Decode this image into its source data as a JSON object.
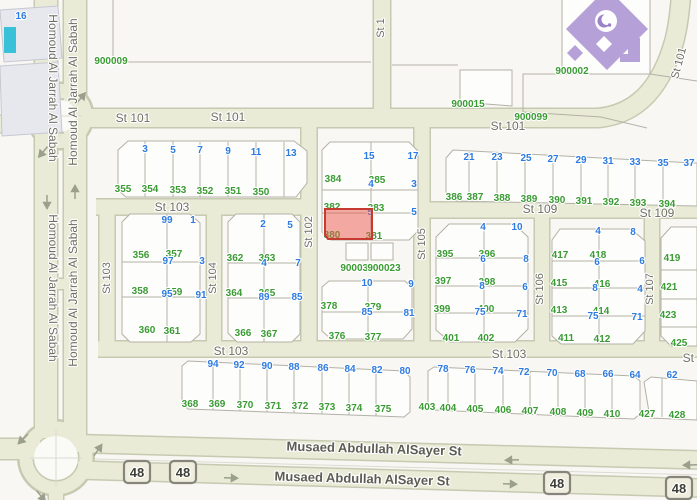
{
  "map": {
    "highlighted_parcel": {
      "number": "380",
      "status": "selected"
    },
    "poi": {
      "type": "mosque",
      "icon": "crescent-and-star"
    },
    "colors": {
      "bg": "#f8f7f4",
      "block_fill": "#fdfdfb",
      "road_fill": "#e9ebd6",
      "road_casing": "#c6cab0",
      "parcel_line": "#b3b1a6",
      "parcel_green": "#3a9b33",
      "address_blue": "#2d7be0",
      "street_text": "#6e6e64",
      "major_street_text": "#5c5c54",
      "highlight_fill": "#ea5548",
      "highlight_stroke": "#c63b30",
      "mosque": "#b6a0d8",
      "building": "#e7e7ee",
      "teal": "#38c1d8",
      "shield_fill": "#efeede",
      "shield_border": "#85857a",
      "arrow": "#9aa08c",
      "inner_circle": "#fafaf7"
    },
    "route_shields": [
      {
        "label": "48",
        "x": 137,
        "y": 472
      },
      {
        "label": "48",
        "x": 183,
        "y": 472
      },
      {
        "label": "48",
        "x": 557,
        "y": 483
      },
      {
        "label": "48",
        "x": 679,
        "y": 488
      }
    ],
    "labels": [
      {
        "t": "St 101",
        "x": 133,
        "y": 122,
        "c": "st"
      },
      {
        "t": "St 101",
        "x": 228,
        "y": 121,
        "c": "st"
      },
      {
        "t": "St 101",
        "x": 508,
        "y": 130,
        "c": "st"
      },
      {
        "t": "St 101",
        "x": 682,
        "y": 64,
        "c": "stv",
        "r": -75
      },
      {
        "t": "St 1",
        "x": 384,
        "y": 28,
        "c": "stv",
        "r": -90
      },
      {
        "t": "St 103",
        "x": 172,
        "y": 211,
        "c": "st"
      },
      {
        "t": "St 103",
        "x": 110,
        "y": 278,
        "c": "stv",
        "r": -90
      },
      {
        "t": "St 102",
        "x": 312,
        "y": 232,
        "c": "stv",
        "r": -90
      },
      {
        "t": "St 104",
        "x": 216,
        "y": 278,
        "c": "stv",
        "r": -90
      },
      {
        "t": "St 105",
        "x": 425,
        "y": 244,
        "c": "stv",
        "r": -90
      },
      {
        "t": "St 109",
        "x": 540,
        "y": 213,
        "c": "st"
      },
      {
        "t": "St 109",
        "x": 657,
        "y": 217,
        "c": "st"
      },
      {
        "t": "St 106",
        "x": 543,
        "y": 289,
        "c": "stv",
        "r": -90
      },
      {
        "t": "St 107",
        "x": 653,
        "y": 289,
        "c": "stv",
        "r": -90
      },
      {
        "t": "St 103",
        "x": 231,
        "y": 355,
        "c": "st"
      },
      {
        "t": "St 103",
        "x": 509,
        "y": 358,
        "c": "st"
      },
      {
        "t": "St 103",
        "x": 700,
        "y": 362,
        "c": "st"
      },
      {
        "t": "Musaed Abdullah AlSayer St",
        "x": 374,
        "y": 453,
        "c": "big",
        "r": 1.6
      },
      {
        "t": "Musaed Abdullah AlSayer St",
        "x": 362,
        "y": 483,
        "c": "big",
        "r": 1.6
      },
      {
        "t": "Homoud Al Jarrah Al Sabah",
        "x": 49,
        "y": 88,
        "c": "st",
        "r": 90
      },
      {
        "t": "Homoud Al Jarrah Al Sabah",
        "x": 49,
        "y": 288,
        "c": "st",
        "r": 90
      },
      {
        "t": "Homoud Al Jarrah Al Sabah",
        "x": 77,
        "y": 92,
        "c": "st",
        "r": -90
      },
      {
        "t": "Homoud Al Jarrah Al Sabah",
        "x": 77,
        "y": 293,
        "c": "st",
        "r": -90
      },
      {
        "t": "355",
        "x": 123,
        "y": 192,
        "c": "g"
      },
      {
        "t": "354",
        "x": 150,
        "y": 192,
        "c": "g"
      },
      {
        "t": "353",
        "x": 178,
        "y": 193,
        "c": "g"
      },
      {
        "t": "352",
        "x": 205,
        "y": 194,
        "c": "g"
      },
      {
        "t": "351",
        "x": 233,
        "y": 194,
        "c": "g"
      },
      {
        "t": "350",
        "x": 261,
        "y": 195,
        "c": "g"
      },
      {
        "t": "356",
        "x": 141,
        "y": 258,
        "c": "g"
      },
      {
        "t": "357",
        "x": 174,
        "y": 257,
        "c": "g"
      },
      {
        "t": "358",
        "x": 140,
        "y": 294,
        "c": "g"
      },
      {
        "t": "359",
        "x": 174,
        "y": 295,
        "c": "g"
      },
      {
        "t": "360",
        "x": 147,
        "y": 333,
        "c": "g"
      },
      {
        "t": "361",
        "x": 172,
        "y": 334,
        "c": "g"
      },
      {
        "t": "362",
        "x": 235,
        "y": 261,
        "c": "g"
      },
      {
        "t": "363",
        "x": 267,
        "y": 261,
        "c": "g"
      },
      {
        "t": "364",
        "x": 234,
        "y": 296,
        "c": "g"
      },
      {
        "t": "365",
        "x": 267,
        "y": 296,
        "c": "g"
      },
      {
        "t": "366",
        "x": 243,
        "y": 336,
        "c": "g"
      },
      {
        "t": "367",
        "x": 269,
        "y": 337,
        "c": "g"
      },
      {
        "t": "384",
        "x": 333,
        "y": 182,
        "c": "g"
      },
      {
        "t": "385",
        "x": 377,
        "y": 183,
        "c": "g"
      },
      {
        "t": "382",
        "x": 332,
        "y": 210,
        "c": "g"
      },
      {
        "t": "383",
        "x": 376,
        "y": 211,
        "c": "g"
      },
      {
        "t": "380",
        "x": 332,
        "y": 238,
        "c": "g"
      },
      {
        "t": "381",
        "x": 374,
        "y": 239,
        "c": "g"
      },
      {
        "t": "378",
        "x": 329,
        "y": 309,
        "c": "g"
      },
      {
        "t": "379",
        "x": 373,
        "y": 310,
        "c": "g"
      },
      {
        "t": "376",
        "x": 337,
        "y": 339,
        "c": "g"
      },
      {
        "t": "377",
        "x": 373,
        "y": 340,
        "c": "g"
      },
      {
        "t": "386",
        "x": 454,
        "y": 200,
        "c": "g"
      },
      {
        "t": "387",
        "x": 475,
        "y": 200,
        "c": "g"
      },
      {
        "t": "388",
        "x": 502,
        "y": 201,
        "c": "g"
      },
      {
        "t": "389",
        "x": 529,
        "y": 202,
        "c": "g"
      },
      {
        "t": "390",
        "x": 557,
        "y": 203,
        "c": "g"
      },
      {
        "t": "391",
        "x": 584,
        "y": 204,
        "c": "g"
      },
      {
        "t": "392",
        "x": 611,
        "y": 205,
        "c": "g"
      },
      {
        "t": "393",
        "x": 638,
        "y": 206,
        "c": "g"
      },
      {
        "t": "394",
        "x": 667,
        "y": 207,
        "c": "g"
      },
      {
        "t": "395",
        "x": 445,
        "y": 257,
        "c": "g"
      },
      {
        "t": "396",
        "x": 487,
        "y": 257,
        "c": "g"
      },
      {
        "t": "397",
        "x": 443,
        "y": 284,
        "c": "g"
      },
      {
        "t": "398",
        "x": 487,
        "y": 285,
        "c": "g"
      },
      {
        "t": "399",
        "x": 442,
        "y": 312,
        "c": "g"
      },
      {
        "t": "400",
        "x": 486,
        "y": 312,
        "c": "g"
      },
      {
        "t": "401",
        "x": 451,
        "y": 341,
        "c": "g"
      },
      {
        "t": "402",
        "x": 486,
        "y": 341,
        "c": "g"
      },
      {
        "t": "417",
        "x": 560,
        "y": 258,
        "c": "g"
      },
      {
        "t": "418",
        "x": 598,
        "y": 258,
        "c": "g"
      },
      {
        "t": "415",
        "x": 559,
        "y": 286,
        "c": "g"
      },
      {
        "t": "416",
        "x": 602,
        "y": 287,
        "c": "g"
      },
      {
        "t": "413",
        "x": 559,
        "y": 313,
        "c": "g"
      },
      {
        "t": "414",
        "x": 601,
        "y": 314,
        "c": "g"
      },
      {
        "t": "411",
        "x": 566,
        "y": 341,
        "c": "g"
      },
      {
        "t": "412",
        "x": 602,
        "y": 342,
        "c": "g"
      },
      {
        "t": "419",
        "x": 672,
        "y": 261,
        "c": "g"
      },
      {
        "t": "421",
        "x": 669,
        "y": 290,
        "c": "g"
      },
      {
        "t": "423",
        "x": 668,
        "y": 318,
        "c": "g"
      },
      {
        "t": "425",
        "x": 679,
        "y": 346,
        "c": "g"
      },
      {
        "t": "368",
        "x": 190,
        "y": 407,
        "c": "g"
      },
      {
        "t": "369",
        "x": 217,
        "y": 407,
        "c": "g"
      },
      {
        "t": "370",
        "x": 245,
        "y": 408,
        "c": "g"
      },
      {
        "t": "371",
        "x": 273,
        "y": 409,
        "c": "g"
      },
      {
        "t": "372",
        "x": 300,
        "y": 409,
        "c": "g"
      },
      {
        "t": "373",
        "x": 327,
        "y": 410,
        "c": "g"
      },
      {
        "t": "374",
        "x": 354,
        "y": 411,
        "c": "g"
      },
      {
        "t": "375",
        "x": 383,
        "y": 412,
        "c": "g"
      },
      {
        "t": "403",
        "x": 427,
        "y": 410,
        "c": "g"
      },
      {
        "t": "404",
        "x": 448,
        "y": 411,
        "c": "g"
      },
      {
        "t": "405",
        "x": 475,
        "y": 412,
        "c": "g"
      },
      {
        "t": "406",
        "x": 503,
        "y": 413,
        "c": "g"
      },
      {
        "t": "407",
        "x": 530,
        "y": 414,
        "c": "g"
      },
      {
        "t": "408",
        "x": 558,
        "y": 415,
        "c": "g"
      },
      {
        "t": "409",
        "x": 585,
        "y": 416,
        "c": "g"
      },
      {
        "t": "410",
        "x": 612,
        "y": 417,
        "c": "g"
      },
      {
        "t": "427",
        "x": 647,
        "y": 417,
        "c": "g"
      },
      {
        "t": "428",
        "x": 677,
        "y": 418,
        "c": "g"
      },
      {
        "t": "900009",
        "x": 111,
        "y": 64,
        "c": "g"
      },
      {
        "t": "900015",
        "x": 468,
        "y": 107,
        "c": "g"
      },
      {
        "t": "900099",
        "x": 531,
        "y": 120,
        "c": "g"
      },
      {
        "t": "900002",
        "x": 572,
        "y": 74,
        "c": "g"
      },
      {
        "t": "900030",
        "x": 357,
        "y": 271,
        "c": "g"
      },
      {
        "t": "900023",
        "x": 384,
        "y": 271,
        "c": "g"
      },
      {
        "t": "3",
        "x": 145,
        "y": 152,
        "c": "b"
      },
      {
        "t": "5",
        "x": 173,
        "y": 153,
        "c": "b"
      },
      {
        "t": "7",
        "x": 200,
        "y": 153,
        "c": "b"
      },
      {
        "t": "9",
        "x": 228,
        "y": 154,
        "c": "b"
      },
      {
        "t": "11",
        "x": 256,
        "y": 155,
        "c": "b"
      },
      {
        "t": "13",
        "x": 291,
        "y": 156,
        "c": "b"
      },
      {
        "t": "99",
        "x": 167,
        "y": 223,
        "c": "b"
      },
      {
        "t": "1",
        "x": 193,
        "y": 223,
        "c": "b"
      },
      {
        "t": "97",
        "x": 168,
        "y": 264,
        "c": "b"
      },
      {
        "t": "3",
        "x": 202,
        "y": 264,
        "c": "b"
      },
      {
        "t": "95",
        "x": 167,
        "y": 297,
        "c": "b"
      },
      {
        "t": "91",
        "x": 201,
        "y": 298,
        "c": "b"
      },
      {
        "t": "2",
        "x": 263,
        "y": 227,
        "c": "b"
      },
      {
        "t": "5",
        "x": 290,
        "y": 228,
        "c": "b"
      },
      {
        "t": "4",
        "x": 264,
        "y": 266,
        "c": "b"
      },
      {
        "t": "7",
        "x": 298,
        "y": 266,
        "c": "b"
      },
      {
        "t": "89",
        "x": 264,
        "y": 300,
        "c": "b"
      },
      {
        "t": "85",
        "x": 297,
        "y": 300,
        "c": "b"
      },
      {
        "t": "15",
        "x": 369,
        "y": 159,
        "c": "b"
      },
      {
        "t": "17",
        "x": 413,
        "y": 159,
        "c": "b"
      },
      {
        "t": "4",
        "x": 371,
        "y": 187,
        "c": "b"
      },
      {
        "t": "3",
        "x": 414,
        "y": 187,
        "c": "b"
      },
      {
        "t": "5",
        "x": 370,
        "y": 215,
        "c": "b"
      },
      {
        "t": "5",
        "x": 414,
        "y": 215,
        "c": "b"
      },
      {
        "t": "10",
        "x": 367,
        "y": 286,
        "c": "b"
      },
      {
        "t": "9",
        "x": 411,
        "y": 287,
        "c": "b"
      },
      {
        "t": "85",
        "x": 367,
        "y": 315,
        "c": "b"
      },
      {
        "t": "81",
        "x": 409,
        "y": 316,
        "c": "b"
      },
      {
        "t": "21",
        "x": 469,
        "y": 160,
        "c": "b"
      },
      {
        "t": "23",
        "x": 497,
        "y": 160,
        "c": "b"
      },
      {
        "t": "25",
        "x": 526,
        "y": 161,
        "c": "b"
      },
      {
        "t": "27",
        "x": 553,
        "y": 162,
        "c": "b"
      },
      {
        "t": "29",
        "x": 581,
        "y": 163,
        "c": "b"
      },
      {
        "t": "31",
        "x": 608,
        "y": 164,
        "c": "b"
      },
      {
        "t": "33",
        "x": 635,
        "y": 165,
        "c": "b"
      },
      {
        "t": "35",
        "x": 663,
        "y": 166,
        "c": "b"
      },
      {
        "t": "37",
        "x": 689,
        "y": 166,
        "c": "b"
      },
      {
        "t": "4",
        "x": 483,
        "y": 230,
        "c": "b"
      },
      {
        "t": "10",
        "x": 517,
        "y": 230,
        "c": "b"
      },
      {
        "t": "6",
        "x": 483,
        "y": 262,
        "c": "b"
      },
      {
        "t": "8",
        "x": 526,
        "y": 262,
        "c": "b"
      },
      {
        "t": "8",
        "x": 482,
        "y": 289,
        "c": "b"
      },
      {
        "t": "6",
        "x": 525,
        "y": 290,
        "c": "b"
      },
      {
        "t": "75",
        "x": 480,
        "y": 315,
        "c": "b"
      },
      {
        "t": "71",
        "x": 522,
        "y": 317,
        "c": "b"
      },
      {
        "t": "4",
        "x": 598,
        "y": 234,
        "c": "b"
      },
      {
        "t": "8",
        "x": 633,
        "y": 235,
        "c": "b"
      },
      {
        "t": "6",
        "x": 597,
        "y": 265,
        "c": "b"
      },
      {
        "t": "6",
        "x": 642,
        "y": 264,
        "c": "b"
      },
      {
        "t": "8",
        "x": 595,
        "y": 291,
        "c": "b"
      },
      {
        "t": "4",
        "x": 640,
        "y": 292,
        "c": "b"
      },
      {
        "t": "75",
        "x": 593,
        "y": 319,
        "c": "b"
      },
      {
        "t": "71",
        "x": 637,
        "y": 320,
        "c": "b"
      },
      {
        "t": "94",
        "x": 213,
        "y": 367,
        "c": "b"
      },
      {
        "t": "92",
        "x": 239,
        "y": 368,
        "c": "b"
      },
      {
        "t": "90",
        "x": 267,
        "y": 369,
        "c": "b"
      },
      {
        "t": "88",
        "x": 294,
        "y": 370,
        "c": "b"
      },
      {
        "t": "86",
        "x": 323,
        "y": 371,
        "c": "b"
      },
      {
        "t": "84",
        "x": 350,
        "y": 372,
        "c": "b"
      },
      {
        "t": "82",
        "x": 377,
        "y": 373,
        "c": "b"
      },
      {
        "t": "80",
        "x": 405,
        "y": 374,
        "c": "b"
      },
      {
        "t": "78",
        "x": 443,
        "y": 372,
        "c": "b"
      },
      {
        "t": "76",
        "x": 470,
        "y": 373,
        "c": "b"
      },
      {
        "t": "74",
        "x": 498,
        "y": 374,
        "c": "b"
      },
      {
        "t": "72",
        "x": 524,
        "y": 375,
        "c": "b"
      },
      {
        "t": "70",
        "x": 552,
        "y": 376,
        "c": "b"
      },
      {
        "t": "68",
        "x": 580,
        "y": 377,
        "c": "b"
      },
      {
        "t": "66",
        "x": 608,
        "y": 377,
        "c": "b"
      },
      {
        "t": "64",
        "x": 635,
        "y": 378,
        "c": "b"
      },
      {
        "t": "62",
        "x": 672,
        "y": 378,
        "c": "b"
      },
      {
        "t": "16",
        "x": 21,
        "y": 19,
        "c": "b"
      }
    ]
  }
}
